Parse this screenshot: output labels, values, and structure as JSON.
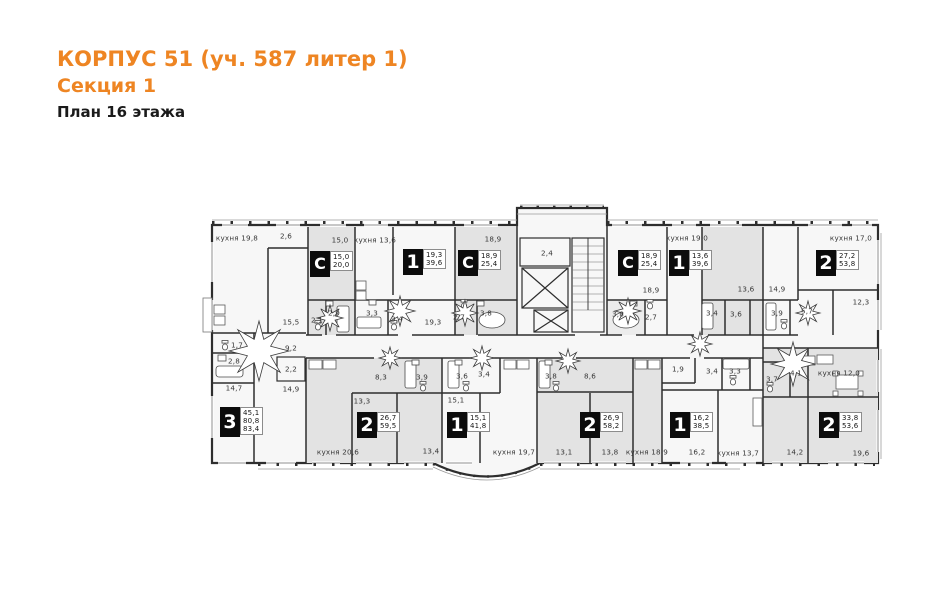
{
  "header": {
    "title": "КОРПУС 51 (уч. 587 литер 1)",
    "subtitle": "Секция 1",
    "plan_caption": "План 16 этажа"
  },
  "colors": {
    "accent": "#ee8523",
    "shaded_unit": "#e3e3e3",
    "plan_background": "#f7f7f7",
    "wall": "#2e2e2e"
  },
  "plan": {
    "apartments": [
      {
        "type": "С",
        "values": [
          "15,0",
          "20,0"
        ],
        "x": 310,
        "y": 251
      },
      {
        "type": "1",
        "values": [
          "19,3",
          "39,6"
        ],
        "x": 403,
        "y": 249
      },
      {
        "type": "С",
        "values": [
          "18,9",
          "25,4"
        ],
        "x": 458,
        "y": 250
      },
      {
        "type": "С",
        "values": [
          "18,9",
          "25,4"
        ],
        "x": 618,
        "y": 250
      },
      {
        "type": "1",
        "values": [
          "13,6",
          "39,6"
        ],
        "x": 669,
        "y": 250
      },
      {
        "type": "2",
        "values": [
          "27,2",
          "53,8"
        ],
        "x": 816,
        "y": 250
      },
      {
        "type": "3",
        "values": [
          "45,1",
          "80,8",
          "83,4"
        ],
        "x": 220,
        "y": 407
      },
      {
        "type": "2",
        "values": [
          "26,7",
          "59,5"
        ],
        "x": 357,
        "y": 412
      },
      {
        "type": "1",
        "values": [
          "15,1",
          "41,8"
        ],
        "x": 447,
        "y": 412
      },
      {
        "type": "2",
        "values": [
          "26,9",
          "58,2"
        ],
        "x": 580,
        "y": 412
      },
      {
        "type": "1",
        "values": [
          "16,2",
          "38,5"
        ],
        "x": 670,
        "y": 412
      },
      {
        "type": "2",
        "values": [
          "33,8",
          "53,6"
        ],
        "x": 819,
        "y": 412
      }
    ],
    "room_labels": [
      {
        "t": "кухня 19,8",
        "x": 237,
        "y": 238
      },
      {
        "t": "2,6",
        "x": 286,
        "y": 236
      },
      {
        "t": "15,0",
        "x": 340,
        "y": 240
      },
      {
        "t": "кухня 13,6",
        "x": 375,
        "y": 240
      },
      {
        "t": "18,9",
        "x": 493,
        "y": 239
      },
      {
        "t": "2,4",
        "x": 547,
        "y": 253
      },
      {
        "t": "18,9",
        "x": 651,
        "y": 290
      },
      {
        "t": "кухня 19,0",
        "x": 687,
        "y": 238
      },
      {
        "t": "кухня 17,0",
        "x": 851,
        "y": 238
      },
      {
        "t": "15,5",
        "x": 291,
        "y": 322
      },
      {
        "t": "2,1",
        "x": 317,
        "y": 320
      },
      {
        "t": "2,9",
        "x": 334,
        "y": 313
      },
      {
        "t": "3,3",
        "x": 372,
        "y": 313
      },
      {
        "t": "3,4",
        "x": 397,
        "y": 319
      },
      {
        "t": "19,3",
        "x": 433,
        "y": 322
      },
      {
        "t": "2,7",
        "x": 459,
        "y": 317
      },
      {
        "t": "3,8",
        "x": 486,
        "y": 313
      },
      {
        "t": "3,8",
        "x": 618,
        "y": 314
      },
      {
        "t": "2,7",
        "x": 651,
        "y": 317
      },
      {
        "t": "13,6",
        "x": 746,
        "y": 289
      },
      {
        "t": "14,9",
        "x": 777,
        "y": 289
      },
      {
        "t": "3,4",
        "x": 712,
        "y": 313
      },
      {
        "t": "3,6",
        "x": 736,
        "y": 314
      },
      {
        "t": "3,9",
        "x": 777,
        "y": 313
      },
      {
        "t": "5,7",
        "x": 807,
        "y": 311
      },
      {
        "t": "12,3",
        "x": 861,
        "y": 302
      },
      {
        "t": "1,7",
        "x": 237,
        "y": 345
      },
      {
        "t": "2,8",
        "x": 234,
        "y": 361
      },
      {
        "t": "14,7",
        "x": 234,
        "y": 388
      },
      {
        "t": "9,2",
        "x": 291,
        "y": 348
      },
      {
        "t": "2,2",
        "x": 291,
        "y": 369
      },
      {
        "t": "14,9",
        "x": 291,
        "y": 389
      },
      {
        "t": "8,3",
        "x": 381,
        "y": 377
      },
      {
        "t": "3,9",
        "x": 422,
        "y": 377
      },
      {
        "t": "13,3",
        "x": 362,
        "y": 401
      },
      {
        "t": "кухня 20,6",
        "x": 338,
        "y": 452
      },
      {
        "t": "13,4",
        "x": 431,
        "y": 451
      },
      {
        "t": "3,6",
        "x": 462,
        "y": 376
      },
      {
        "t": "3,4",
        "x": 484,
        "y": 374
      },
      {
        "t": "15,1",
        "x": 456,
        "y": 400
      },
      {
        "t": "кухня 19,7",
        "x": 514,
        "y": 452
      },
      {
        "t": "3,8",
        "x": 551,
        "y": 376
      },
      {
        "t": "8,6",
        "x": 590,
        "y": 376
      },
      {
        "t": "13,1",
        "x": 564,
        "y": 452
      },
      {
        "t": "13,8",
        "x": 610,
        "y": 452
      },
      {
        "t": "кухня 18,9",
        "x": 647,
        "y": 452
      },
      {
        "t": "1,9",
        "x": 678,
        "y": 369
      },
      {
        "t": "3,4",
        "x": 712,
        "y": 371
      },
      {
        "t": "3,3",
        "x": 735,
        "y": 371
      },
      {
        "t": "3,7",
        "x": 772,
        "y": 379
      },
      {
        "t": "4,1",
        "x": 796,
        "y": 373
      },
      {
        "t": "кухня 12,0",
        "x": 839,
        "y": 373
      },
      {
        "t": "16,2",
        "x": 697,
        "y": 452
      },
      {
        "t": "кухня 13,7",
        "x": 738,
        "y": 453
      },
      {
        "t": "14,2",
        "x": 795,
        "y": 452
      },
      {
        "t": "19,6",
        "x": 861,
        "y": 453
      }
    ],
    "door_markers": [
      {
        "x": 259,
        "y": 351,
        "r": 30
      },
      {
        "x": 330,
        "y": 318,
        "r": 13
      },
      {
        "x": 400,
        "y": 311,
        "r": 15
      },
      {
        "x": 465,
        "y": 313,
        "r": 13
      },
      {
        "x": 628,
        "y": 311,
        "r": 13
      },
      {
        "x": 390,
        "y": 358,
        "r": 11
      },
      {
        "x": 482,
        "y": 358,
        "r": 12
      },
      {
        "x": 568,
        "y": 361,
        "r": 12
      },
      {
        "x": 700,
        "y": 344,
        "r": 12
      },
      {
        "x": 793,
        "y": 364,
        "r": 22
      },
      {
        "x": 808,
        "y": 313,
        "r": 12
      }
    ]
  }
}
